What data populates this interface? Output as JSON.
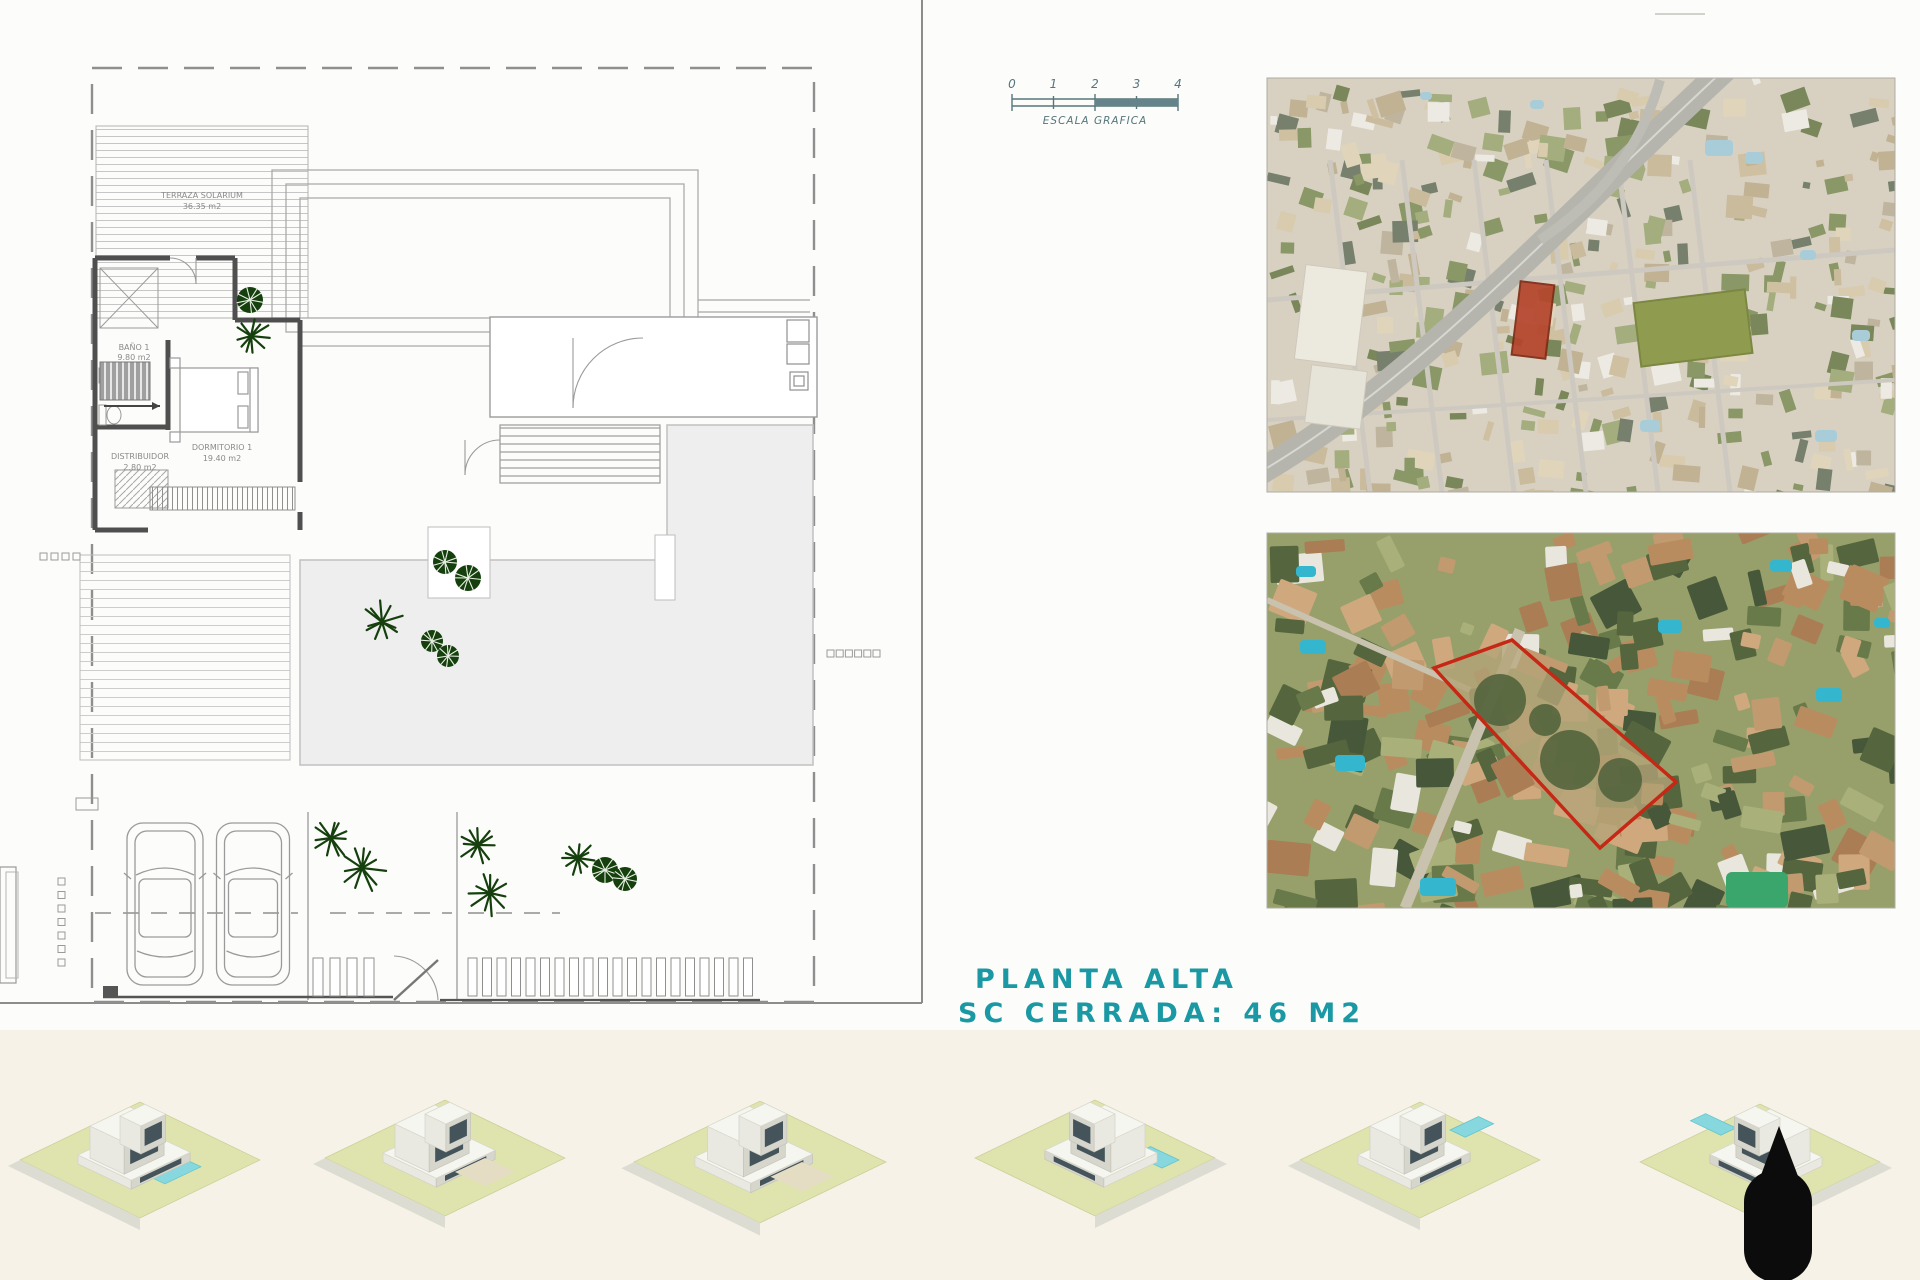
{
  "floor_plan": {
    "rooms": {
      "terraza": {
        "name": "TERRAZA SOLARIUM",
        "area": "36.35 m2"
      },
      "bano": {
        "name": "BAÑO 1",
        "area": "9.80 m2"
      },
      "dormitorio": {
        "name": "DORMITORIO 1",
        "area": "19.40 m2"
      },
      "distribuidor": {
        "name": "DISTRIBUIDOR",
        "area": "2.80 m2"
      }
    }
  },
  "scale_bar": {
    "ticks": [
      "0",
      "1",
      "2",
      "3",
      "4"
    ],
    "label": "ESCALA GRAFICA"
  },
  "title": {
    "line1": "PLANTA ALTA",
    "line2": "SC CERRADA: 46 M2"
  },
  "colors": {
    "title_teal": "#1a98a4",
    "scale_teal": "#56767b",
    "plot_marker_red": "#b5452c",
    "plot_outline_red": "#c52815",
    "palm_green": "#15400e",
    "lawn_green": "#dfe3ad",
    "pool_blue": "#86d7de",
    "bottom_band_cream": "#f6f2e7"
  }
}
